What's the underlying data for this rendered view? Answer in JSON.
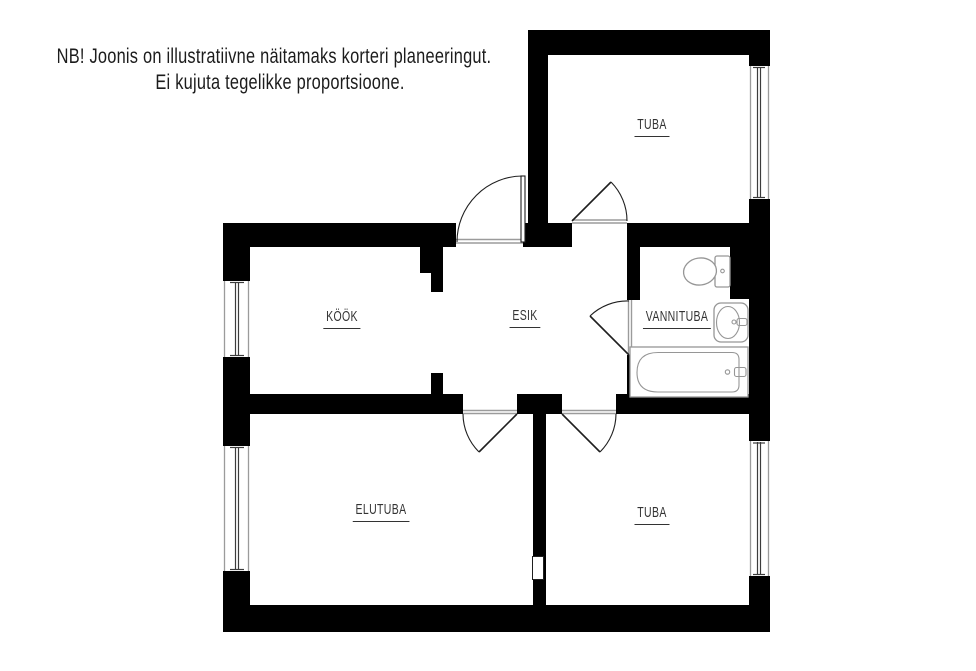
{
  "note": {
    "line1": "NB! Joonis on illustratiivne näitamaks korteri planeeringut.",
    "line2": "Ei kujuta tegelikke proportsioone."
  },
  "rooms": [
    {
      "key": "tuba_top",
      "name": "TUBA"
    },
    {
      "key": "kook",
      "name": "KÖÖK"
    },
    {
      "key": "esik",
      "name": "ESIK"
    },
    {
      "key": "vannituba",
      "name": "VANNITUBA"
    },
    {
      "key": "elutuba",
      "name": "ELUTUBA"
    },
    {
      "key": "tuba_bottom",
      "name": "TUBA"
    }
  ],
  "fixtures": [
    {
      "icon": "toilet-icon"
    },
    {
      "icon": "sink-icon"
    },
    {
      "icon": "bathtub-icon"
    }
  ],
  "features": {
    "windows": 4,
    "doors": 5,
    "open_passages": 1
  },
  "colors": {
    "wall": "#000000",
    "background": "#ffffff",
    "door_line": "#1f1f1f",
    "threshold_line": "#9b9b9b",
    "window_glass": "#3c3c3c",
    "window_frame": "#9b9b9b",
    "fixture_outline": "#969696",
    "text": "#333333"
  }
}
